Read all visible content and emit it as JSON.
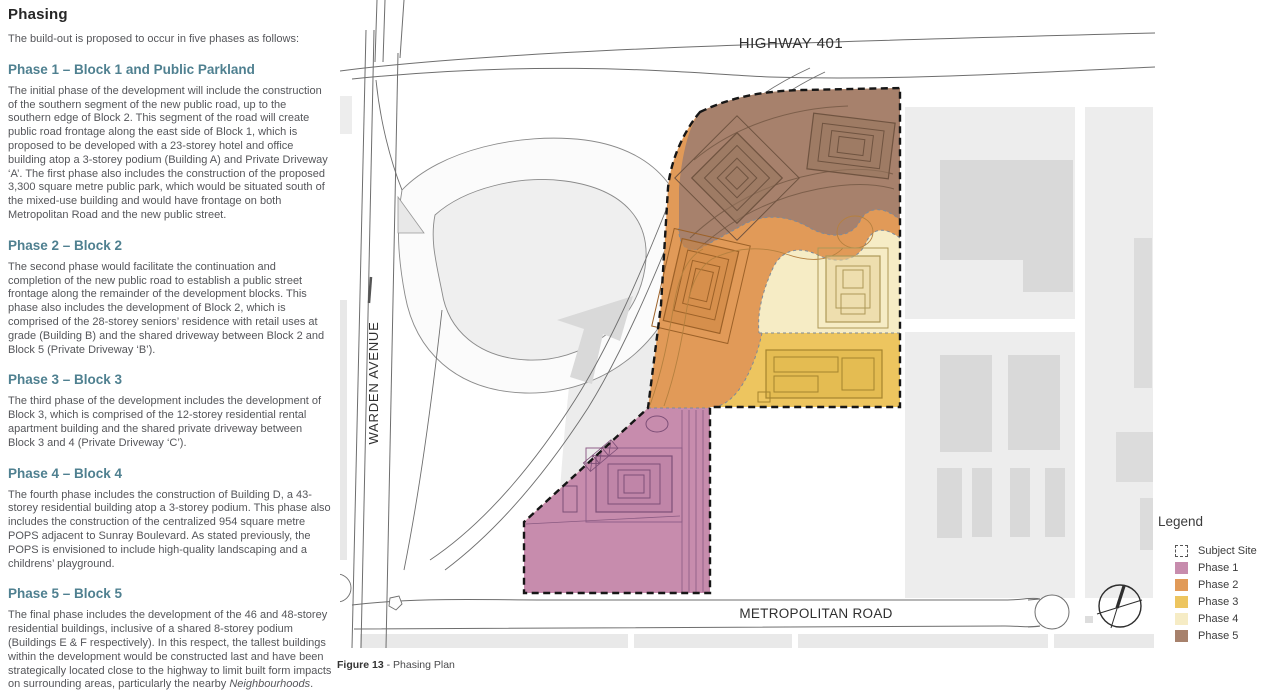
{
  "page": {
    "title": "Phasing",
    "intro": "The build-out is proposed to occur in five phases as follows:",
    "sections": [
      {
        "heading": "Phase 1 – Block 1 and Public Parkland",
        "segments": [
          {
            "text": "The initial phase of the development will include the construction of the southern segment of the new public road, up to the southern edge of Block 2. This segment of the road will create public road frontage along the east side of Block 1, which is proposed to be developed with a 23-storey hotel and office building atop a 3-storey podium (Building A) and Private Driveway ‘A’. The first phase also includes the construction of the proposed 3,300 square metre public park, which would be situated south of the mixed-use building and would have frontage on both Metropolitan Road and the new public street.",
            "italic": false
          }
        ]
      },
      {
        "heading": "Phase 2 – Block 2",
        "segments": [
          {
            "text": "The second phase would facilitate the continuation and completion of the new public road to establish a public street frontage along the remainder of the development blocks. This phase also includes the development of Block 2, which is comprised of the 28-storey seniors’ residence with retail uses at grade (Building B) and the shared driveway between Block 2 and Block 5 (Private Driveway ‘B’).",
            "italic": false
          }
        ]
      },
      {
        "heading": "Phase 3 – Block 3",
        "segments": [
          {
            "text": "The third phase of the development includes the development of Block 3, which is comprised of the 12-storey residential rental apartment building and the shared private driveway between Block 3 and 4 (Private Driveway ‘C’).",
            "italic": false
          }
        ]
      },
      {
        "heading": "Phase 4 – Block 4",
        "segments": [
          {
            "text": "The fourth phase includes the construction of Building D, a 43-storey residential building atop a 3-storey podium. This phase also includes the construction of the centralized 954 square metre POPS adjacent to Sunray Boulevard. As stated previously, the POPS is envisioned to include high-quality landscaping and a childrens’ playground.",
            "italic": false
          }
        ]
      },
      {
        "heading": "Phase 5 – Block 5",
        "segments": [
          {
            "text": "The final phase includes the development of the 46 and 48-storey residential buildings, inclusive of a shared 8-storey podium (Buildings E & F respectively).  In this respect, the tallest buildings within the development would be constructed last and have been strategically located close to the highway to limit built form impacts on surrounding areas, particularly the nearby ",
            "italic": false
          },
          {
            "text": "Neighbourhoods",
            "italic": true
          },
          {
            "text": ".",
            "italic": false
          }
        ]
      }
    ]
  },
  "map": {
    "labels": {
      "highway": "HIGHWAY 401",
      "warden": "WARDEN AVENUE",
      "metropolitan": "METROPOLITAN ROAD"
    }
  },
  "legend": {
    "title": "Legend",
    "items": [
      {
        "label": "Subject Site",
        "type": "dashed",
        "color": "#ffffff"
      },
      {
        "label": "Phase 1",
        "type": "fill",
        "color": "#c78cad"
      },
      {
        "label": "Phase 2",
        "type": "fill",
        "color": "#e19a58"
      },
      {
        "label": "Phase 3",
        "type": "fill",
        "color": "#edc55f"
      },
      {
        "label": "Phase 4",
        "type": "fill",
        "color": "#f6ecc5"
      },
      {
        "label": "Phase 5",
        "type": "fill",
        "color": "#a7816c"
      }
    ]
  },
  "caption": {
    "figure": "Figure 13",
    "text": "- Phasing Plan"
  }
}
